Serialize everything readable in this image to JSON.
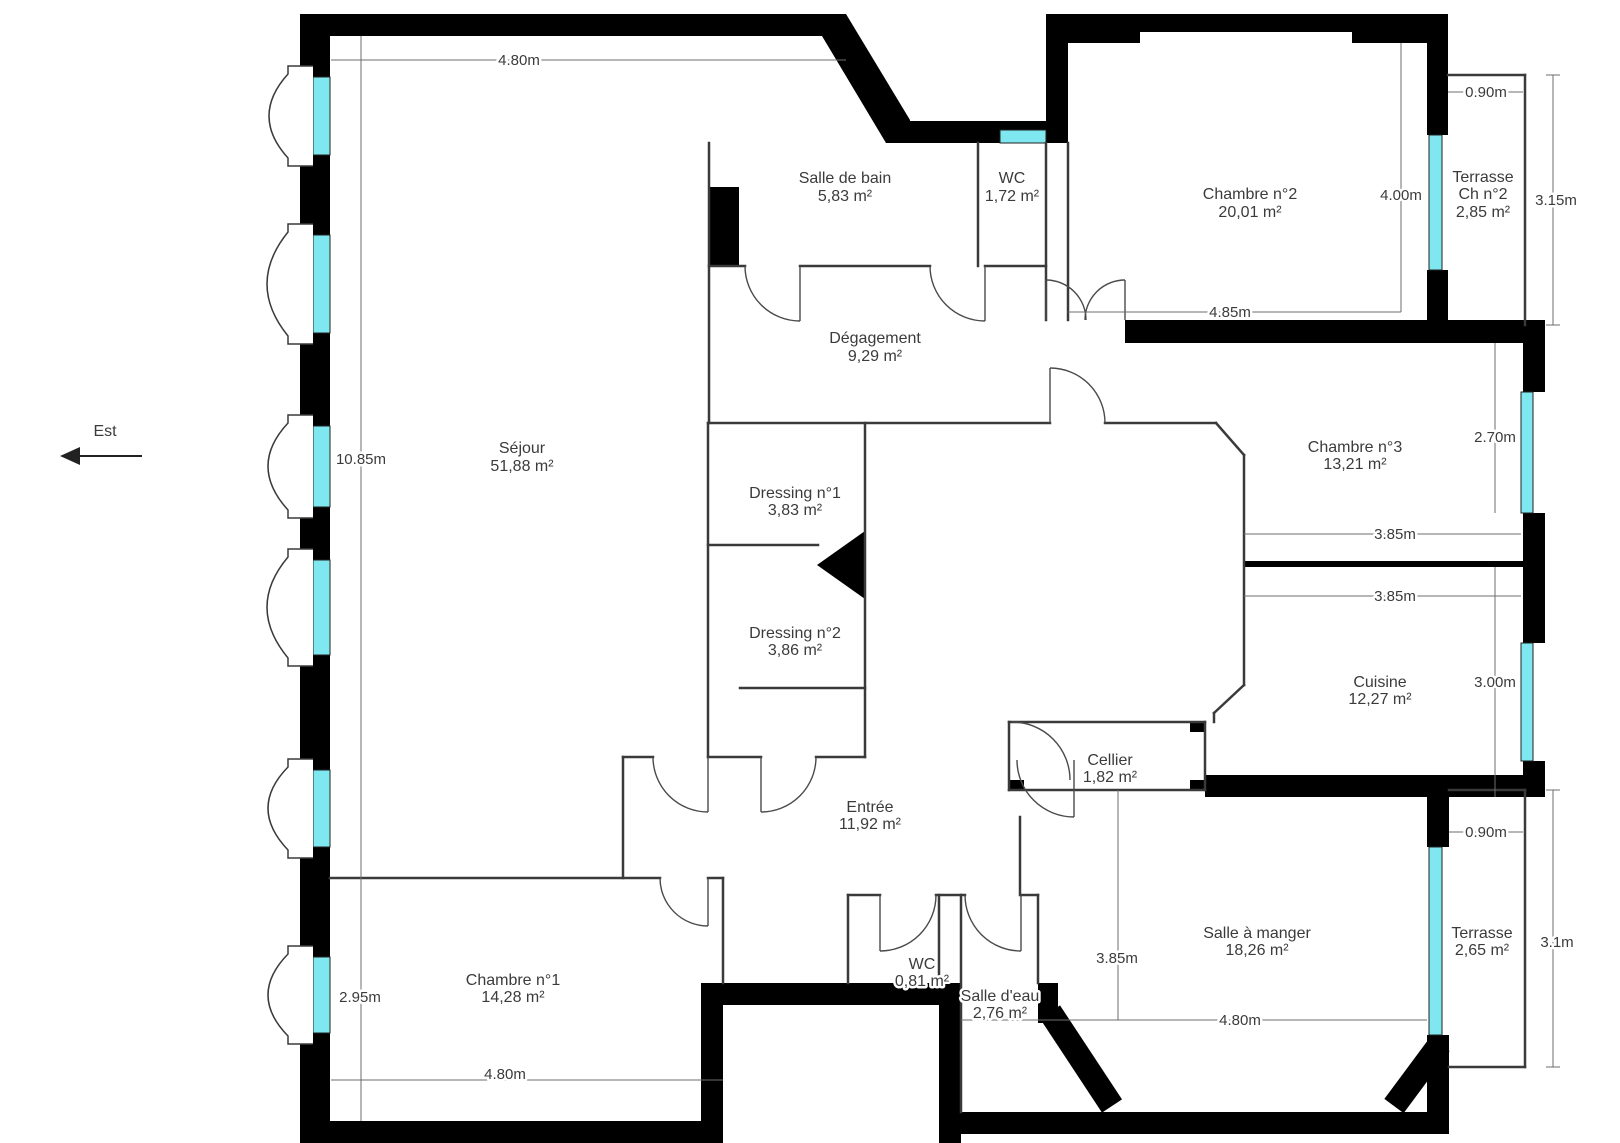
{
  "plan": {
    "compass": {
      "label": "Est"
    },
    "rooms": {
      "salle_de_bain": {
        "name": "Salle de bain",
        "area": "5,83  m²"
      },
      "wc_haut": {
        "name": "WC",
        "area": "1,72  m²"
      },
      "chambre2": {
        "name": "Chambre n°2",
        "area": "20,01  m²"
      },
      "terrasse_ch2": {
        "name": "Terrasse",
        "name2": "Ch n°2",
        "area": "2,85  m²"
      },
      "degagement": {
        "name": "Dégagement",
        "area": "9,29  m²"
      },
      "sejour": {
        "name": "Séjour",
        "area": "51,88  m²"
      },
      "dressing1": {
        "name": "Dressing n°1",
        "area": "3,83  m²"
      },
      "dressing2": {
        "name": "Dressing n°2",
        "area": "3,86  m²"
      },
      "chambre3": {
        "name": "Chambre n°3",
        "area": "13,21  m²"
      },
      "cuisine": {
        "name": "Cuisine",
        "area": "12,27  m²"
      },
      "cellier": {
        "name": "Cellier",
        "area": "1,82  m²"
      },
      "entree": {
        "name": "Entrée",
        "area": "11,92  m²"
      },
      "chambre1": {
        "name": "Chambre n°1",
        "area": "14,28  m²"
      },
      "wc_bas": {
        "name": "WC",
        "area": "0,81  m²"
      },
      "salle_deau": {
        "name": "Salle d'eau",
        "area": "2,76  m²"
      },
      "salle_a_manger": {
        "name": "Salle à manger",
        "area": "18,26  m²"
      },
      "terrasse_bas": {
        "name": "Terrasse",
        "area": "2,65  m²"
      }
    },
    "dims": {
      "top_480": "4.80m",
      "tr_090": "0.90m",
      "ch2_400": "4.00m",
      "ter2_315": "3.15m",
      "ch2_485": "4.85m",
      "sejour_1085": "10.85m",
      "ch3_270": "2.70m",
      "ch3_385": "3.85m",
      "cuisine_385": "3.85m",
      "cuisine_300": "3.00m",
      "br_090": "0.90m",
      "ter_31": "3.1m",
      "ch1_295": "2.95m",
      "sam_385": "3.85m",
      "sam_480": "4.80m",
      "ch1_480": "4.80m"
    },
    "colors": {
      "wall": "#000000",
      "window": "#7ee7ef"
    }
  }
}
